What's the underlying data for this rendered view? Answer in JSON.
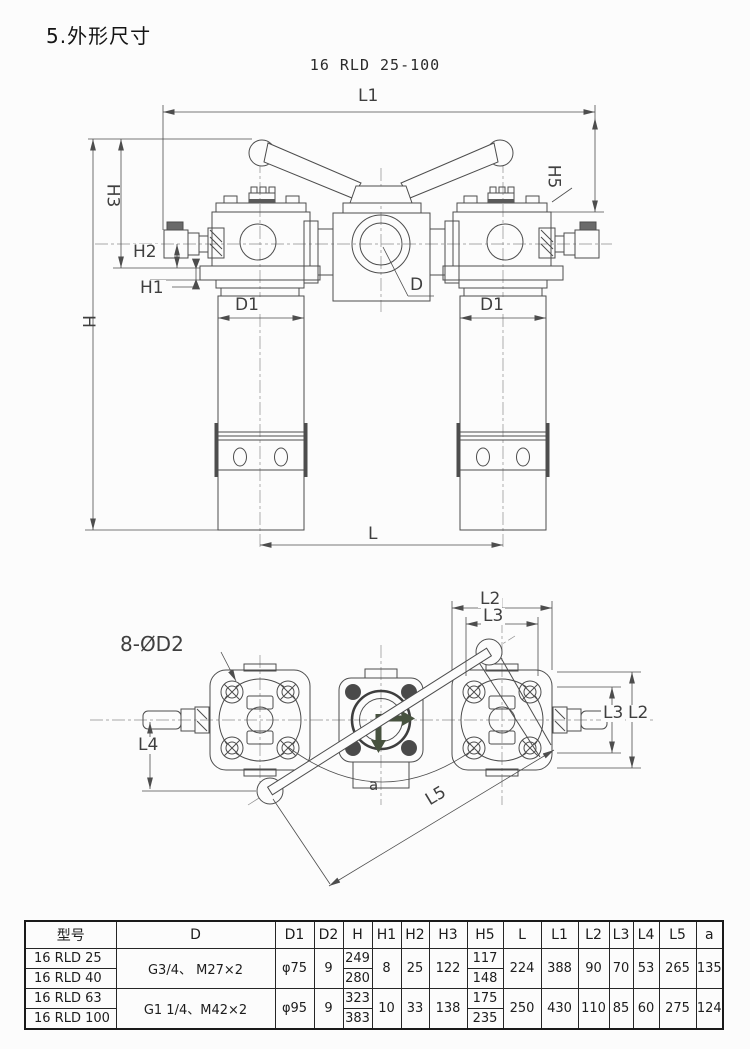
{
  "page": {
    "title": "5.外形尺寸",
    "subtitle": "16 RLD 25-100"
  },
  "colors": {
    "line": "#4d4d4d",
    "flow_arrow": "#47523f",
    "paper": "#fcfcfc"
  },
  "front_view": {
    "labels": {
      "l1": "L1",
      "h5": "H5",
      "h3": "H3",
      "h2": "H2",
      "h1": "H1",
      "h": "H",
      "d1_left": "D1",
      "d1_right": "D1",
      "d": "D",
      "l": "L"
    }
  },
  "plan_view": {
    "labels": {
      "bolt_callout": "8-ØD2",
      "l2_top": "L2",
      "l3_top": "L3",
      "l3_right": "L3",
      "l2_right": "L2",
      "l4": "L4",
      "angle": "a",
      "l5": "L5"
    }
  },
  "table": {
    "headers": [
      "型号",
      "D",
      "D1",
      "D2",
      "H",
      "H1",
      "H2",
      "H3",
      "H5",
      "L",
      "L1",
      "L2",
      "L3",
      "L4",
      "L5",
      "a"
    ],
    "groups": [
      {
        "models": [
          "16 RLD 25",
          "16 RLD 40"
        ],
        "d": "G3/4、  M27×2",
        "d1": "φ75",
        "d2": "9",
        "h": [
          "249",
          "280"
        ],
        "h1": "8",
        "h2": "25",
        "h3": "122",
        "h5": [
          "117",
          "148"
        ],
        "l": "224",
        "l1": "388",
        "l2": "90",
        "l3": "70",
        "l4": "53",
        "l5": "265",
        "a": "135"
      },
      {
        "models": [
          "16 RLD 63",
          "16 RLD 100"
        ],
        "d": "G1 1/4、M42×2",
        "d1": "φ95",
        "d2": "9",
        "h": [
          "323",
          "383"
        ],
        "h1": "10",
        "h2": "33",
        "h3": "138",
        "h5": [
          "175",
          "235"
        ],
        "l": "250",
        "l1": "430",
        "l2": "110",
        "l3": "85",
        "l4": "60",
        "l5": "275",
        "a": "124"
      }
    ]
  }
}
